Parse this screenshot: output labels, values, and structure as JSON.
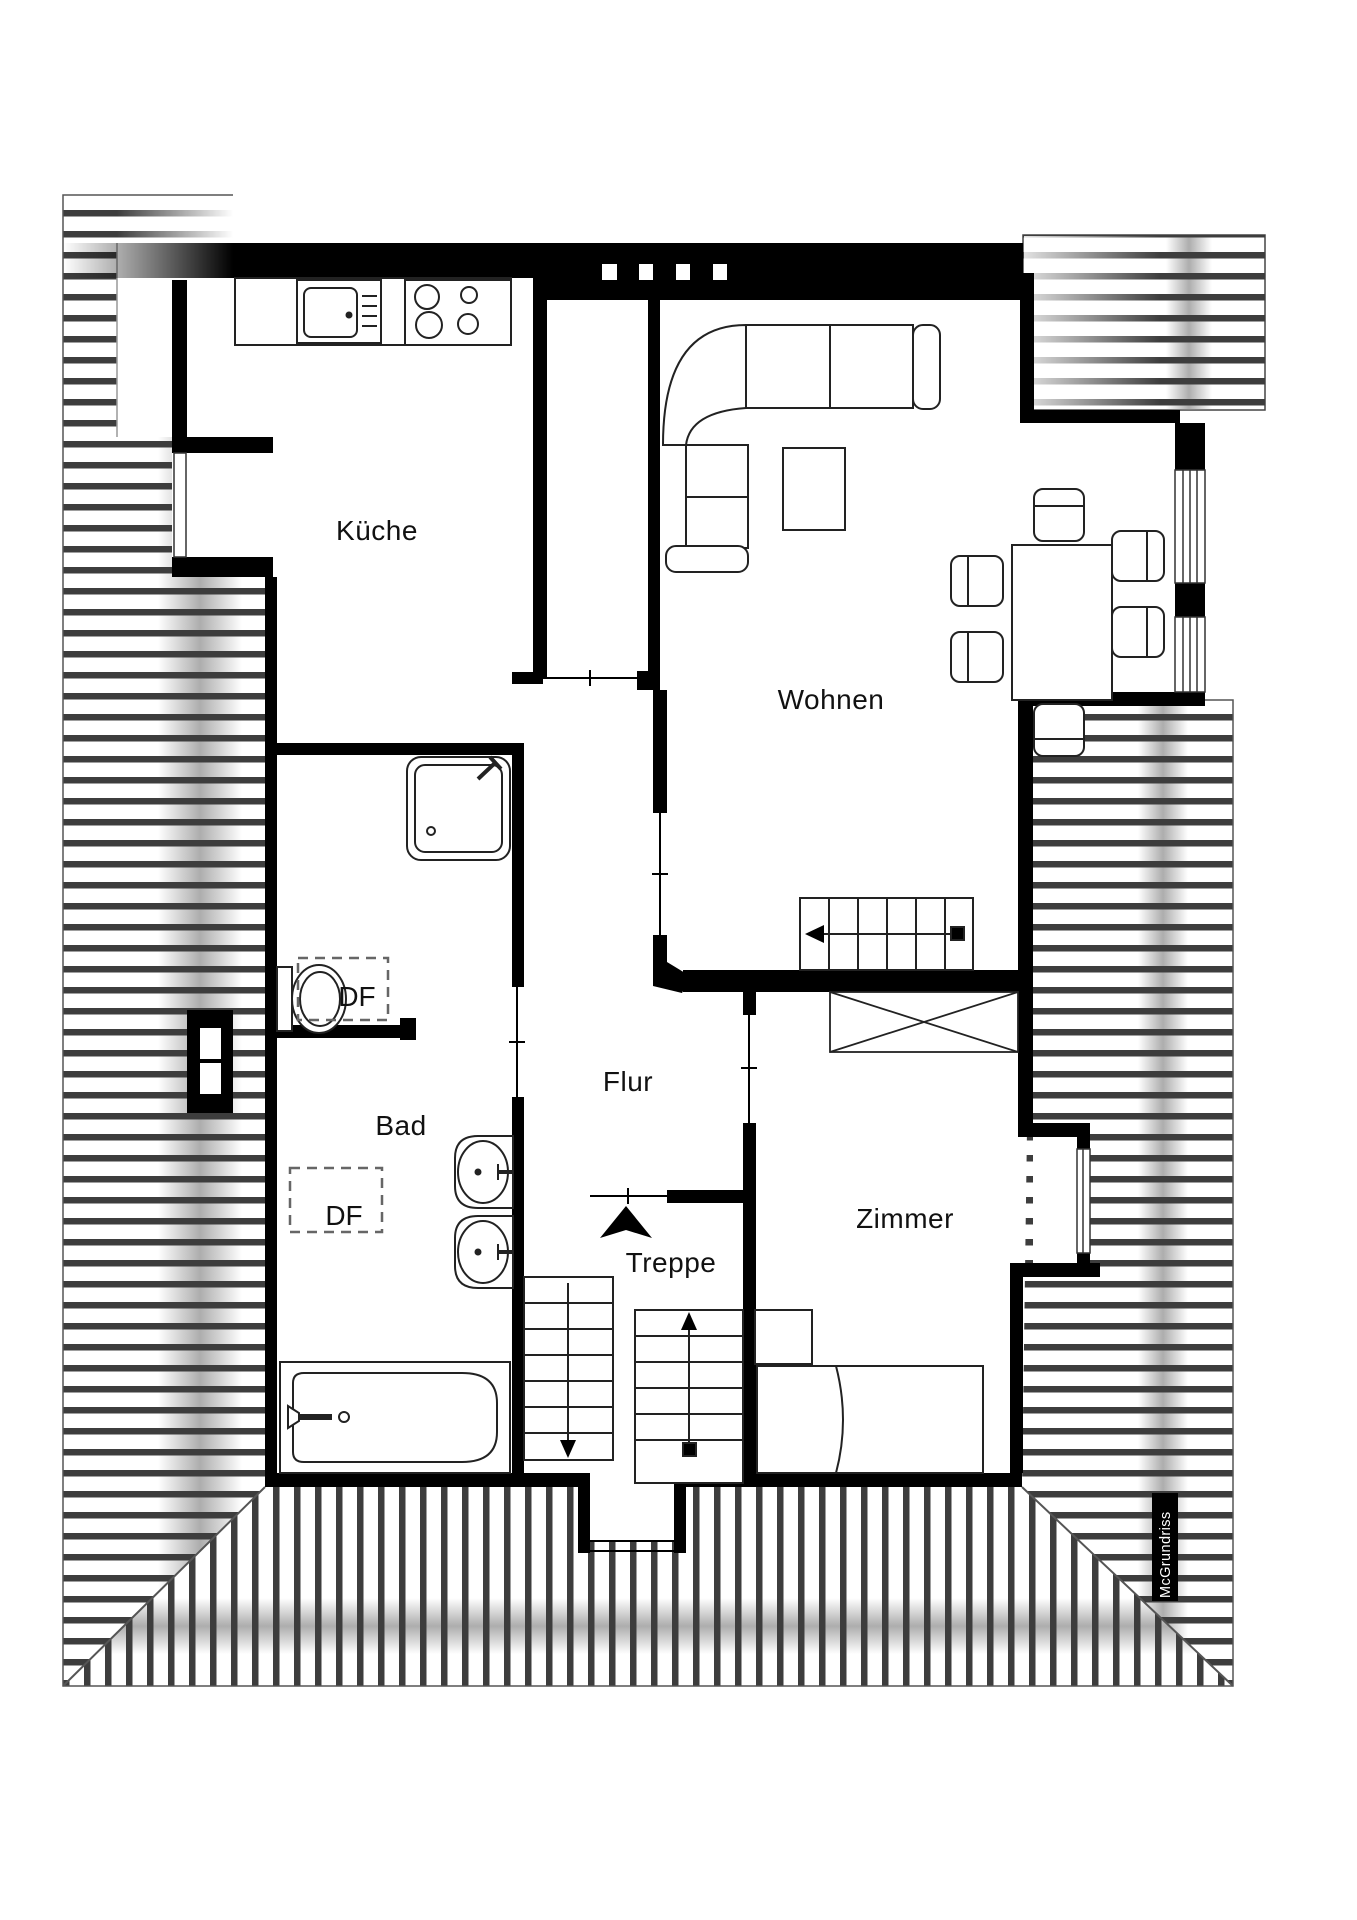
{
  "page": {
    "type": "architectural-floor-plan",
    "background": "#ffffff"
  },
  "rooms": [
    {
      "id": "kueche",
      "label": "Küche"
    },
    {
      "id": "wohnen",
      "label": "Wohnen"
    },
    {
      "id": "bad",
      "label": "Bad"
    },
    {
      "id": "flur",
      "label": "Flur"
    },
    {
      "id": "treppe",
      "label": "Treppe"
    },
    {
      "id": "zimmer",
      "label": "Zimmer"
    }
  ],
  "skylights": [
    {
      "id": "df-wc",
      "label": "DF"
    },
    {
      "id": "df-bad",
      "label": "DF"
    }
  ],
  "watermark": {
    "label": "McGrundriss",
    "background": "#000000",
    "color": "#ffffff"
  },
  "colors": {
    "wall": "#000000",
    "furniture_line": "#222222",
    "hatch_line": "#3d3d3d",
    "label": "#111111",
    "ridge_shadow": "#8a8a8a"
  },
  "icons": [
    "stove-icon",
    "kitchen-sink-icon",
    "shower-icon",
    "toilet-icon",
    "washbasin-icon",
    "bathtub-icon",
    "corner-sofa-icon",
    "coffee-table-icon",
    "dining-table-icon",
    "chair-icon",
    "bed-icon",
    "nightstand-icon",
    "stairs-icon",
    "skylight-icon",
    "void-cross-icon",
    "entrance-arrow-icon"
  ]
}
